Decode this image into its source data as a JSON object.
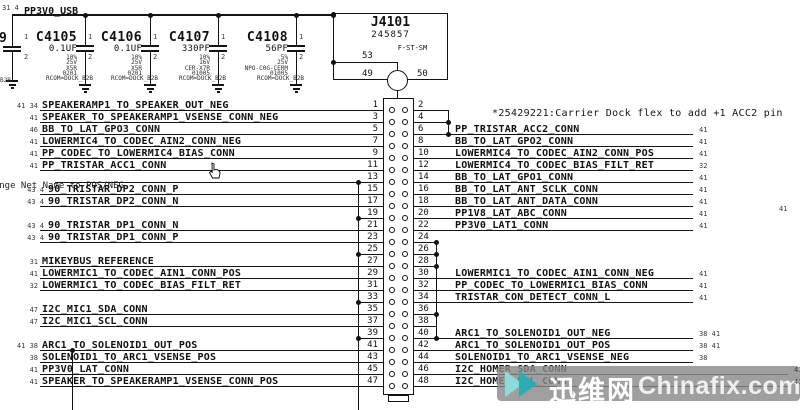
{
  "power_rail": {
    "net": "PP3V0_USB",
    "refs": "31 4"
  },
  "partial_component": {
    "ref_fragment": "9",
    "pin1": "1",
    "pin2": "2",
    "text_fragment": "B2B"
  },
  "capacitors": [
    {
      "ref": "C4105",
      "value": "0.1UF",
      "tolerance": "10%",
      "voltage": "25V",
      "dielectric": "X5R",
      "package": "0201",
      "note": "RCOM=DOCK_B2B",
      "pin1": "1",
      "pin2": "2"
    },
    {
      "ref": "C4106",
      "value": "0.1UF",
      "tolerance": "10%",
      "voltage": "25V",
      "dielectric": "X5R",
      "package": "0201",
      "note": "RCOM=DOCK_B2B",
      "pin1": "1",
      "pin2": "2"
    },
    {
      "ref": "C4107",
      "value": "330PF",
      "tolerance": "10%",
      "voltage": "16V",
      "dielectric": "CER-X7R",
      "package": "01005",
      "note": "RCOM=DOCK_B2B",
      "pin1": "1",
      "pin2": "2"
    },
    {
      "ref": "C4108",
      "value": "56PF",
      "tolerance": "5%",
      "voltage": "25V",
      "dielectric": "NPO-C0G-CERM",
      "package": "01005",
      "note": "RCOM=DOCK_B2B",
      "pin1": "1",
      "pin2": "2"
    }
  ],
  "connector": {
    "ref": "J4101",
    "part_number": "245857",
    "package": "F-ST-SM",
    "shell_pins": {
      "top": "53",
      "left": "49",
      "right": "50"
    },
    "rows": [
      {
        "l": {
          "pin": "1",
          "kind": "net",
          "label": "SPEAKERAMP1_TO_SPEAKER_OUT_NEG",
          "refs": "41 34"
        },
        "r": {
          "pin": "2",
          "kind": "stub"
        }
      },
      {
        "l": {
          "pin": "3",
          "kind": "net",
          "label": "SPEAKER_TO_SPEAKERAMP1_VSENSE_CONN_NEG",
          "refs": "41"
        },
        "r": {
          "pin": "4",
          "kind": "stub"
        }
      },
      {
        "l": {
          "pin": "5",
          "kind": "net",
          "label": "BB_TO_LAT_GPO3_CONN",
          "refs": "46"
        },
        "r": {
          "pin": "6",
          "kind": "net",
          "label": "PP_TRISTAR_ACC2_CONN",
          "refs": "41"
        }
      },
      {
        "l": {
          "pin": "7",
          "kind": "net",
          "label": "LOWERMIC4_TO_CODEC_AIN2_CONN_NEG",
          "refs": "41"
        },
        "r": {
          "pin": "8",
          "kind": "net",
          "label": "BB_TO_LAT_GPO2_CONN",
          "refs": "41"
        }
      },
      {
        "l": {
          "pin": "9",
          "kind": "net",
          "label": "PP_CODEC_TO_LOWERMIC4_BIAS_CONN",
          "refs": "41"
        },
        "r": {
          "pin": "10",
          "kind": "net",
          "label": "LOWERMIC4_TO_CODEC_AIN2_CONN_POS",
          "refs": "41"
        }
      },
      {
        "l": {
          "pin": "11",
          "kind": "net",
          "label": "PP_TRISTAR_ACC1_CONN",
          "refs": "41"
        },
        "r": {
          "pin": "12",
          "kind": "net",
          "label": "LOWERMIC4_TO_CODEC_BIAS_FILT_RET",
          "refs": "32"
        }
      },
      {
        "l": {
          "pin": "13",
          "kind": "net",
          "label": ""
        },
        "r": {
          "pin": "14",
          "kind": "net",
          "label": "BB_TO_LAT_GPO1_CONN",
          "refs": "41"
        }
      },
      {
        "l": {
          "pin": "15",
          "kind": "net",
          "label": "90_TRISTAR_DP2_CONN_P",
          "refs": "43 4"
        },
        "r": {
          "pin": "16",
          "kind": "net",
          "label": "BB_TO_LAT_ANT_SCLK_CONN",
          "refs": "41"
        }
      },
      {
        "l": {
          "pin": "17",
          "kind": "net",
          "label": "90_TRISTAR_DP2_CONN_N",
          "refs": "43 4"
        },
        "r": {
          "pin": "18",
          "kind": "net",
          "label": "BB_TO_LAT_ANT_DATA_CONN",
          "refs": "41"
        }
      },
      {
        "l": {
          "pin": "19",
          "kind": "bus"
        },
        "r": {
          "pin": "20",
          "kind": "net",
          "label": "PP1V8_LAT_ABC_CONN",
          "refs": "41"
        }
      },
      {
        "l": {
          "pin": "21",
          "kind": "net",
          "label": "90_TRISTAR_DP1_CONN_N",
          "refs": "43 4"
        },
        "r": {
          "pin": "22",
          "kind": "net",
          "label": "PP3V0_LAT1_CONN",
          "refs": "41"
        }
      },
      {
        "l": {
          "pin": "23",
          "kind": "net",
          "label": "90_TRISTAR_DP1_CONN_P",
          "refs": "43 4"
        },
        "r": {
          "pin": "24",
          "kind": "bus"
        }
      },
      {
        "l": {
          "pin": "25",
          "kind": "bus"
        },
        "r": {
          "pin": "26",
          "kind": "bus"
        }
      },
      {
        "l": {
          "pin": "27",
          "kind": "net",
          "label": "MIKEYBUS_REFERENCE",
          "refs": "31"
        },
        "r": {
          "pin": "28",
          "kind": "bus"
        }
      },
      {
        "l": {
          "pin": "29",
          "kind": "net",
          "label": "LOWERMIC1_TO_CODEC_AIN1_CONN_POS",
          "refs": "41"
        },
        "r": {
          "pin": "30",
          "kind": "net",
          "label": "LOWERMIC1_TO_CODEC_AIN1_CONN_NEG",
          "refs": "41"
        }
      },
      {
        "l": {
          "pin": "31",
          "kind": "net",
          "label": "LOWERMIC1_TO_CODEC_BIAS_FILT_RET",
          "refs": "32"
        },
        "r": {
          "pin": "32",
          "kind": "net",
          "label": "PP_CODEC_TO_LOWERMIC1_BIAS_CONN",
          "refs": "41"
        }
      },
      {
        "l": {
          "pin": "33",
          "kind": "bus"
        },
        "r": {
          "pin": "34",
          "kind": "net",
          "label": "TRISTAR_CON_DETECT_CONN_L",
          "refs": "41"
        }
      },
      {
        "l": {
          "pin": "35",
          "kind": "net",
          "label": "I2C_MIC1_SDA_CONN",
          "refs": "47"
        },
        "r": {
          "pin": "36",
          "kind": "bus"
        }
      },
      {
        "l": {
          "pin": "37",
          "kind": "net",
          "label": "I2C_MIC1_SCL_CONN",
          "refs": "47"
        },
        "r": {
          "pin": "38",
          "kind": "stub"
        }
      },
      {
        "l": {
          "pin": "39",
          "kind": "bus"
        },
        "r": {
          "pin": "40",
          "kind": "net",
          "label": "ARC1_TO_SOLENOID1_OUT_NEG",
          "refs": "38 41"
        }
      },
      {
        "l": {
          "pin": "41",
          "kind": "net",
          "label": "ARC1_TO_SOLENOID1_OUT_POS",
          "refs": "41 38"
        },
        "r": {
          "pin": "42",
          "kind": "net",
          "label": "ARC1_TO_SOLENOID1_OUT_POS",
          "refs": "38 41"
        }
      },
      {
        "l": {
          "pin": "43",
          "kind": "net",
          "label": "SOLENOID1_TO_ARC1_VSENSE_POS",
          "refs": "38"
        },
        "r": {
          "pin": "44",
          "kind": "net",
          "label": "SOLENOID1_TO_ARC1_VSENSE_NEG",
          "refs": "38"
        }
      },
      {
        "l": {
          "pin": "45",
          "kind": "net",
          "label": "PP3V0_LAT_CONN",
          "refs": "41"
        },
        "r": {
          "pin": "46",
          "kind": "net",
          "label": "I2C_HOMER_SDA_CONN",
          "refs": "41"
        }
      },
      {
        "l": {
          "pin": "47",
          "kind": "net",
          "label": "SPEAKER_TO_SPEAKERAMP1_VSENSE_CONN_POS",
          "refs": "41"
        },
        "r": {
          "pin": "48",
          "kind": "net",
          "label": "I2C_HOMER_SCL_CONN",
          "refs": "41"
        }
      }
    ]
  },
  "annotations": {
    "change_note": "Change Net Name to POS/NEG",
    "eco_note": "*25429221:Carrier Dock flex to add +1 ACC2 pin",
    "stray_ref": "41"
  },
  "watermark": {
    "cjk": "迅维网",
    "site": "Chinafix.com",
    "teal_dark": "#2aacb2",
    "teal_light": "#8fd9db",
    "band_color": "#8a8a8a"
  }
}
